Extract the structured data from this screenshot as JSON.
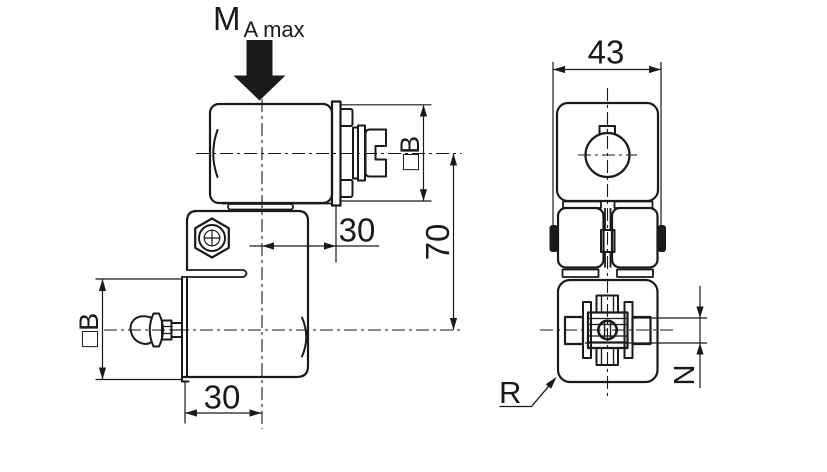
{
  "drawing": {
    "load_label": {
      "main": "M",
      "sub": "A max"
    },
    "front_view": {
      "dim_square_b_top": "□B",
      "dim_center_offset_top": "30",
      "dim_height": "70",
      "dim_square_b_bottom": "□B",
      "dim_center_offset_bottom": "30"
    },
    "side_view": {
      "dim_width": "43",
      "label_radius": "R",
      "label_n": "N"
    },
    "colors": {
      "line": "#1a1a1a",
      "background": "#ffffff"
    }
  }
}
